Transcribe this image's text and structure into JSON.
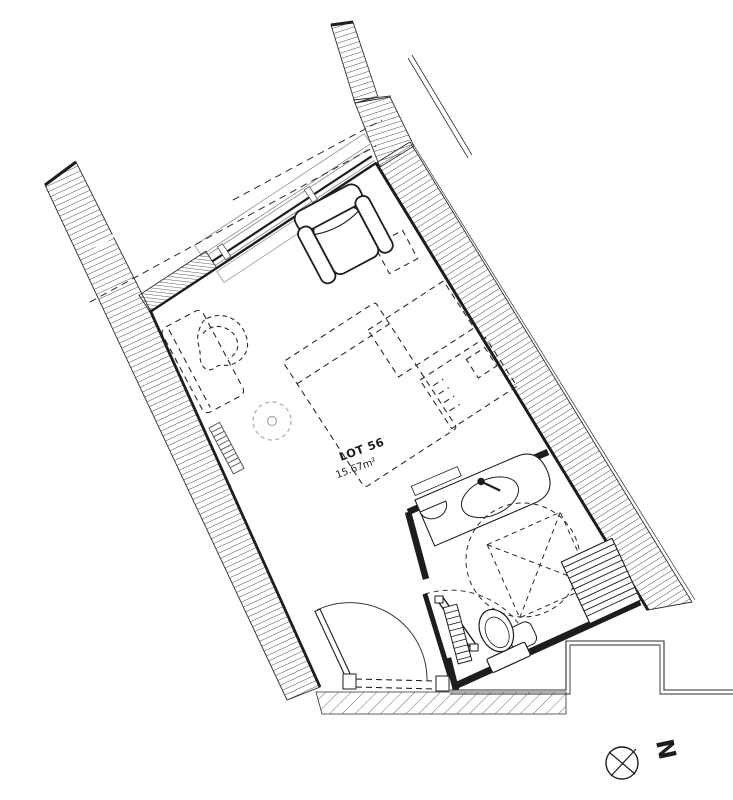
{
  "plan": {
    "lot_label": "LOT 56",
    "area_label": "15.67m²"
  },
  "north": {
    "letter": "N"
  },
  "colors": {
    "ink": "#1d1d1f",
    "hatch": "#3a3a3c",
    "gray": "#8f8f94",
    "background": "#ffffff"
  }
}
